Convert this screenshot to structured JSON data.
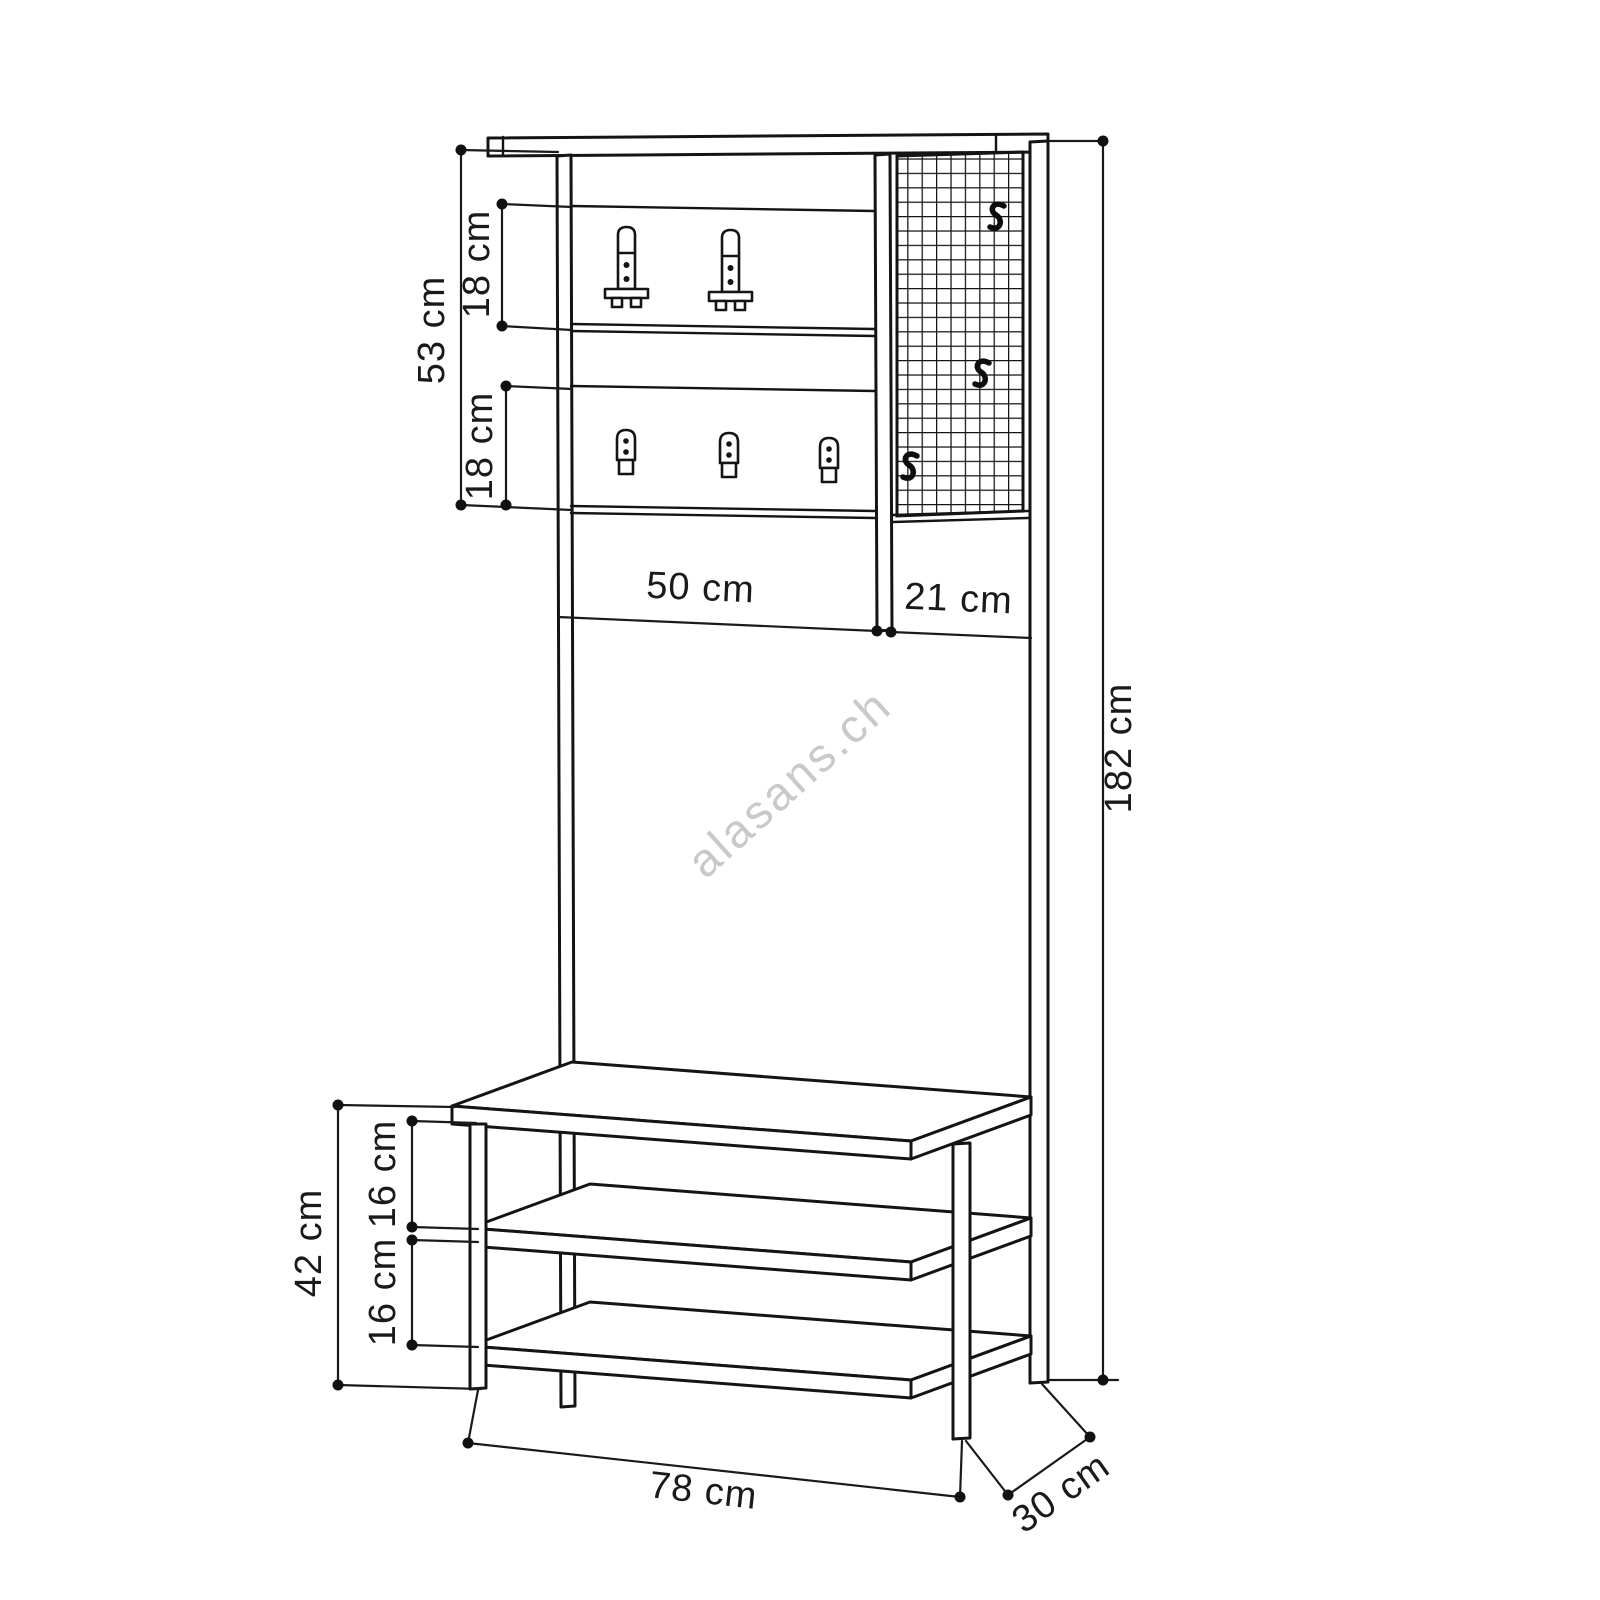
{
  "watermark": "alasans.ch",
  "labels": {
    "upper_section_height": "53 cm",
    "upper_hook_panel_height": "18 cm",
    "lower_hook_panel_height": "18 cm",
    "panel_width": "50 cm",
    "grid_panel_width": "21 cm",
    "total_height": "182 cm",
    "bench_height": "42 cm",
    "shelf_gap_upper": "16 cm",
    "shelf_gap_lower": "16 cm",
    "total_width": "78 cm",
    "depth": "30 cm"
  }
}
